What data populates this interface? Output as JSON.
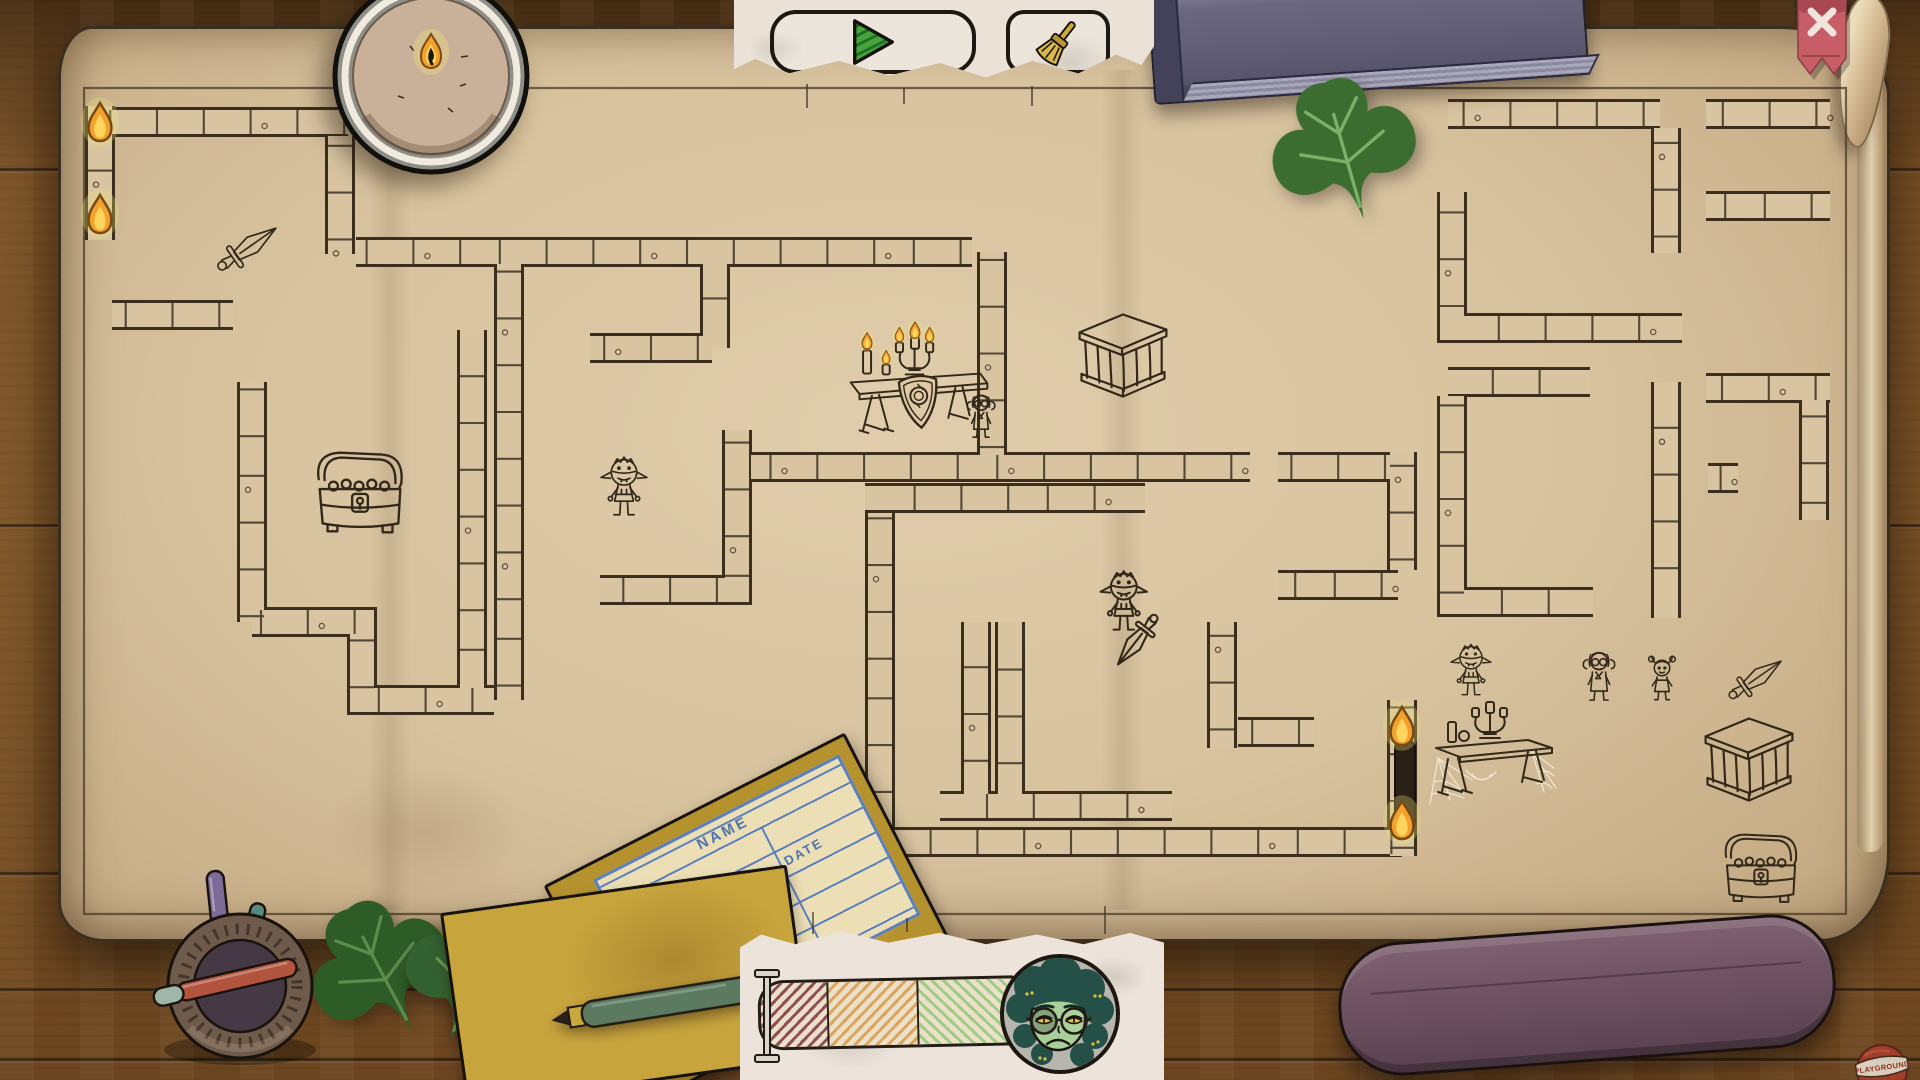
{
  "app": {
    "logo_text": "PLAYGROUND"
  },
  "toolbar": {
    "buttons": [
      {
        "id": "play",
        "icon": "play-triangle-icon"
      },
      {
        "id": "clean",
        "icon": "broom-icon"
      }
    ]
  },
  "close_ribbon": {
    "icon": "x-icon",
    "color": "#c75d66"
  },
  "paper_form": {
    "name_label": "NAME",
    "date_label": "DATE"
  },
  "progress": {
    "base_color": "#ece1c8",
    "segments": [
      {
        "id": "low",
        "line_color": "#8d5059",
        "width": 66
      },
      {
        "id": "mid",
        "line_color": "#d9a55f",
        "width": 88
      },
      {
        "id": "high",
        "line_color": "#9ecb86",
        "width": 92
      }
    ],
    "slider_value": 0,
    "avatar": "medusa-librarian"
  },
  "map": {
    "frame": [
      84,
      88,
      1846,
      914
    ],
    "walls": [
      [
        [
          100,
          106
        ],
        [
          100,
          240
        ]
      ],
      [
        [
          104,
          122
        ],
        [
          348,
          122
        ]
      ],
      [
        [
          340,
          136
        ],
        [
          340,
          254
        ]
      ],
      [
        [
          112,
          315
        ],
        [
          233,
          315
        ]
      ],
      [
        [
          356,
          252
        ],
        [
          972,
          252
        ]
      ],
      [
        [
          992,
          252
        ],
        [
          992,
          455
        ]
      ],
      [
        [
          252,
          382
        ],
        [
          252,
          622
        ]
      ],
      [
        [
          252,
          622
        ],
        [
          362,
          622
        ],
        [
          362,
          700
        ],
        [
          494,
          700
        ]
      ],
      [
        [
          472,
          330
        ],
        [
          472,
          700
        ]
      ],
      [
        [
          509,
          262
        ],
        [
          509,
          700
        ]
      ],
      [
        [
          715,
          252
        ],
        [
          715,
          348
        ]
      ],
      [
        [
          590,
          348
        ],
        [
          712,
          348
        ]
      ],
      [
        [
          737,
          430
        ],
        [
          737,
          590
        ],
        [
          600,
          590
        ]
      ],
      [
        [
          751,
          467
        ],
        [
          1250,
          467
        ]
      ],
      [
        [
          865,
          498
        ],
        [
          1145,
          498
        ]
      ],
      [
        [
          1278,
          467
        ],
        [
          1400,
          467
        ]
      ],
      [
        [
          880,
          513
        ],
        [
          880,
          844
        ]
      ],
      [
        [
          940,
          806
        ],
        [
          1172,
          806
        ]
      ],
      [
        [
          832,
          842
        ],
        [
          1402,
          842
        ]
      ],
      [
        [
          976,
          622
        ],
        [
          976,
          806
        ]
      ],
      [
        [
          1010,
          622
        ],
        [
          1010,
          806
        ]
      ],
      [
        [
          1222,
          622
        ],
        [
          1222,
          748
        ]
      ],
      [
        [
          1238,
          732
        ],
        [
          1314,
          732
        ]
      ],
      [
        [
          1402,
          452
        ],
        [
          1402,
          570
        ]
      ],
      [
        [
          1278,
          585
        ],
        [
          1398,
          585
        ]
      ],
      [
        [
          1402,
          700
        ],
        [
          1402,
          856
        ]
      ],
      [
        [
          1448,
          114
        ],
        [
          1660,
          114
        ]
      ],
      [
        [
          1666,
          128
        ],
        [
          1666,
          253
        ]
      ],
      [
        [
          1706,
          114
        ],
        [
          1830,
          114
        ]
      ],
      [
        [
          1706,
          206
        ],
        [
          1830,
          206
        ]
      ],
      [
        [
          1452,
          192
        ],
        [
          1452,
          328
        ],
        [
          1682,
          328
        ]
      ],
      [
        [
          1448,
          382
        ],
        [
          1590,
          382
        ]
      ],
      [
        [
          1452,
          396
        ],
        [
          1452,
          602
        ],
        [
          1593,
          602
        ]
      ],
      [
        [
          1666,
          382
        ],
        [
          1666,
          618
        ]
      ],
      [
        [
          1706,
          388
        ],
        [
          1830,
          388
        ]
      ],
      [
        [
          1814,
          400
        ],
        [
          1814,
          520
        ]
      ],
      [
        [
          1708,
          478
        ],
        [
          1738,
          478
        ]
      ]
    ],
    "items": [
      {
        "type": "torch",
        "x": 83,
        "y": 100,
        "w": 34,
        "h": 46
      },
      {
        "type": "torch",
        "x": 83,
        "y": 192,
        "w": 34,
        "h": 46
      },
      {
        "type": "dagger",
        "x": 210,
        "y": 218,
        "w": 78,
        "h": 58,
        "rot": -35
      },
      {
        "type": "chest",
        "x": 302,
        "y": 442,
        "w": 116,
        "h": 98
      },
      {
        "type": "goblin",
        "x": 598,
        "y": 452,
        "w": 52,
        "h": 78
      },
      {
        "type": "scene-table",
        "x": 824,
        "y": 318,
        "w": 182,
        "h": 136
      },
      {
        "type": "cage",
        "x": 1068,
        "y": 306,
        "w": 110,
        "h": 100
      },
      {
        "type": "goblin-sword",
        "x": 1098,
        "y": 566,
        "w": 80,
        "h": 114
      },
      {
        "type": "door",
        "x": 1392,
        "y": 738,
        "w": 26,
        "h": 94
      },
      {
        "type": "torch",
        "x": 1385,
        "y": 704,
        "w": 34,
        "h": 46
      },
      {
        "type": "torch",
        "x": 1385,
        "y": 798,
        "w": 34,
        "h": 46
      },
      {
        "type": "goblin",
        "x": 1448,
        "y": 640,
        "w": 46,
        "h": 68
      },
      {
        "type": "librarian",
        "x": 1580,
        "y": 648,
        "w": 38,
        "h": 58
      },
      {
        "type": "girl",
        "x": 1645,
        "y": 655,
        "w": 34,
        "h": 52
      },
      {
        "type": "dagger",
        "x": 1722,
        "y": 650,
        "w": 70,
        "h": 56,
        "rot": -35
      },
      {
        "type": "web-table",
        "x": 1428,
        "y": 700,
        "w": 132,
        "h": 108
      },
      {
        "type": "cage",
        "x": 1698,
        "y": 710,
        "w": 102,
        "h": 100
      },
      {
        "type": "chest",
        "x": 1712,
        "y": 822,
        "w": 98,
        "h": 90
      }
    ]
  },
  "colors": {
    "ink": "#32281a",
    "wall_dark": "#3b2e1d",
    "wall_fill": "#d8c4a1",
    "parchment": "#d8c4a2",
    "wood": "#7a5126",
    "accent_green": "#49a33b",
    "flame": "#f2a12d",
    "ivy_green": "#35632c",
    "card_yellow": "#c9a53e",
    "line_blue": "#4a72b4",
    "eraser_purple": "#6b4f5e",
    "book_purple": "#5d5a72",
    "ribbon_red": "#c75d66"
  }
}
